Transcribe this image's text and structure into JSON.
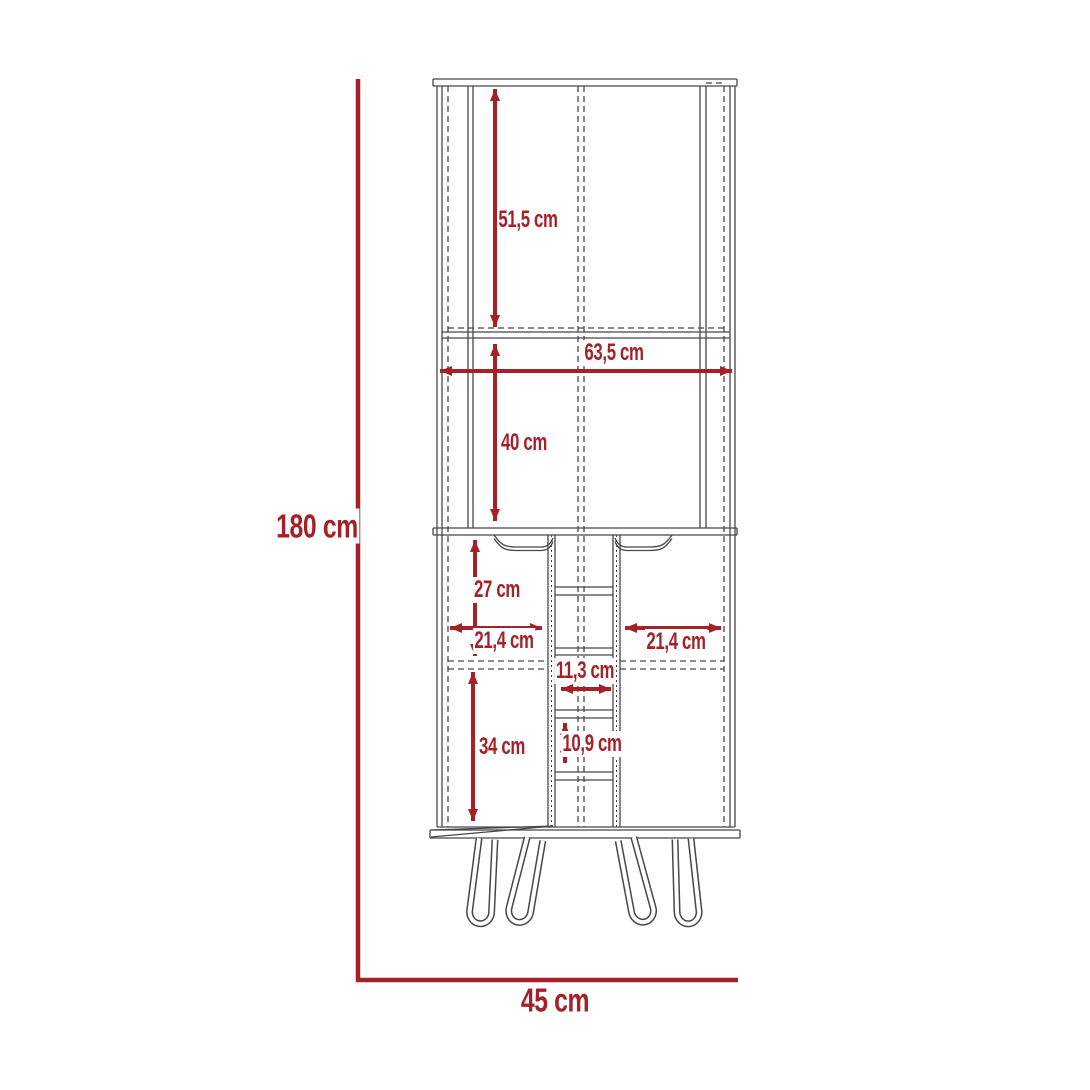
{
  "figure": {
    "type": "furniture-dimension-diagram",
    "unit": "cm"
  },
  "dimensions": {
    "total_height": "180 cm",
    "total_depth": "45 cm",
    "upper_section_height": "51,5 cm",
    "total_width": "63,5 cm",
    "middle_section_height": "40 cm",
    "door_upper_height": "27 cm",
    "left_door_width": "21,4 cm",
    "right_door_width": "21,4 cm",
    "center_column_width": "11,3 cm",
    "door_lower_height": "34 cm",
    "center_shelf_spacing": "10,9 cm"
  },
  "colors": {
    "dimension_accent": "#A62028",
    "drawing_line": "#474747",
    "background": "#FFFFFF"
  }
}
